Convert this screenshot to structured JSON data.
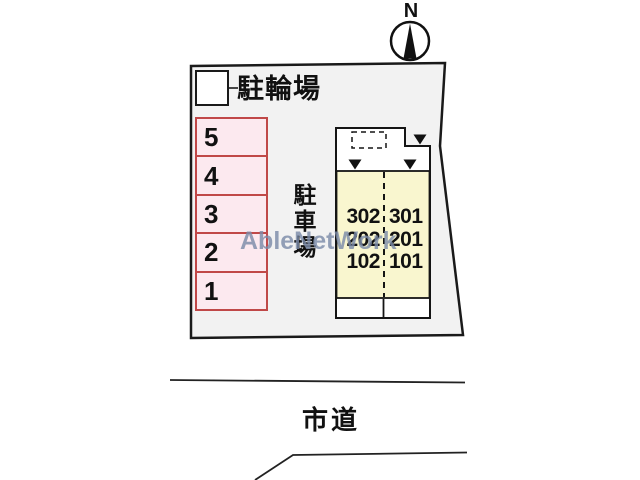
{
  "compass": {
    "label": "N"
  },
  "plot": {
    "bicycle_parking": {
      "label": "駐輪場"
    },
    "parking_lot": {
      "label": "駐車場",
      "spaces": [
        "5",
        "4",
        "3",
        "2",
        "1"
      ]
    },
    "building": {
      "rooms": [
        [
          "302",
          "301"
        ],
        [
          "202",
          "201"
        ],
        [
          "102",
          "101"
        ]
      ]
    }
  },
  "road": {
    "label": "市道"
  },
  "watermark": {
    "text": "AbleNetWork"
  },
  "colors": {
    "plot_fill": "#f2f2f2",
    "parking_space_fill": "#fce9ef",
    "parking_space_border": "#c04848",
    "building_fill": "#f9f6cf",
    "outline": "#1a1a1a",
    "watermark": "#7b8ba8"
  }
}
